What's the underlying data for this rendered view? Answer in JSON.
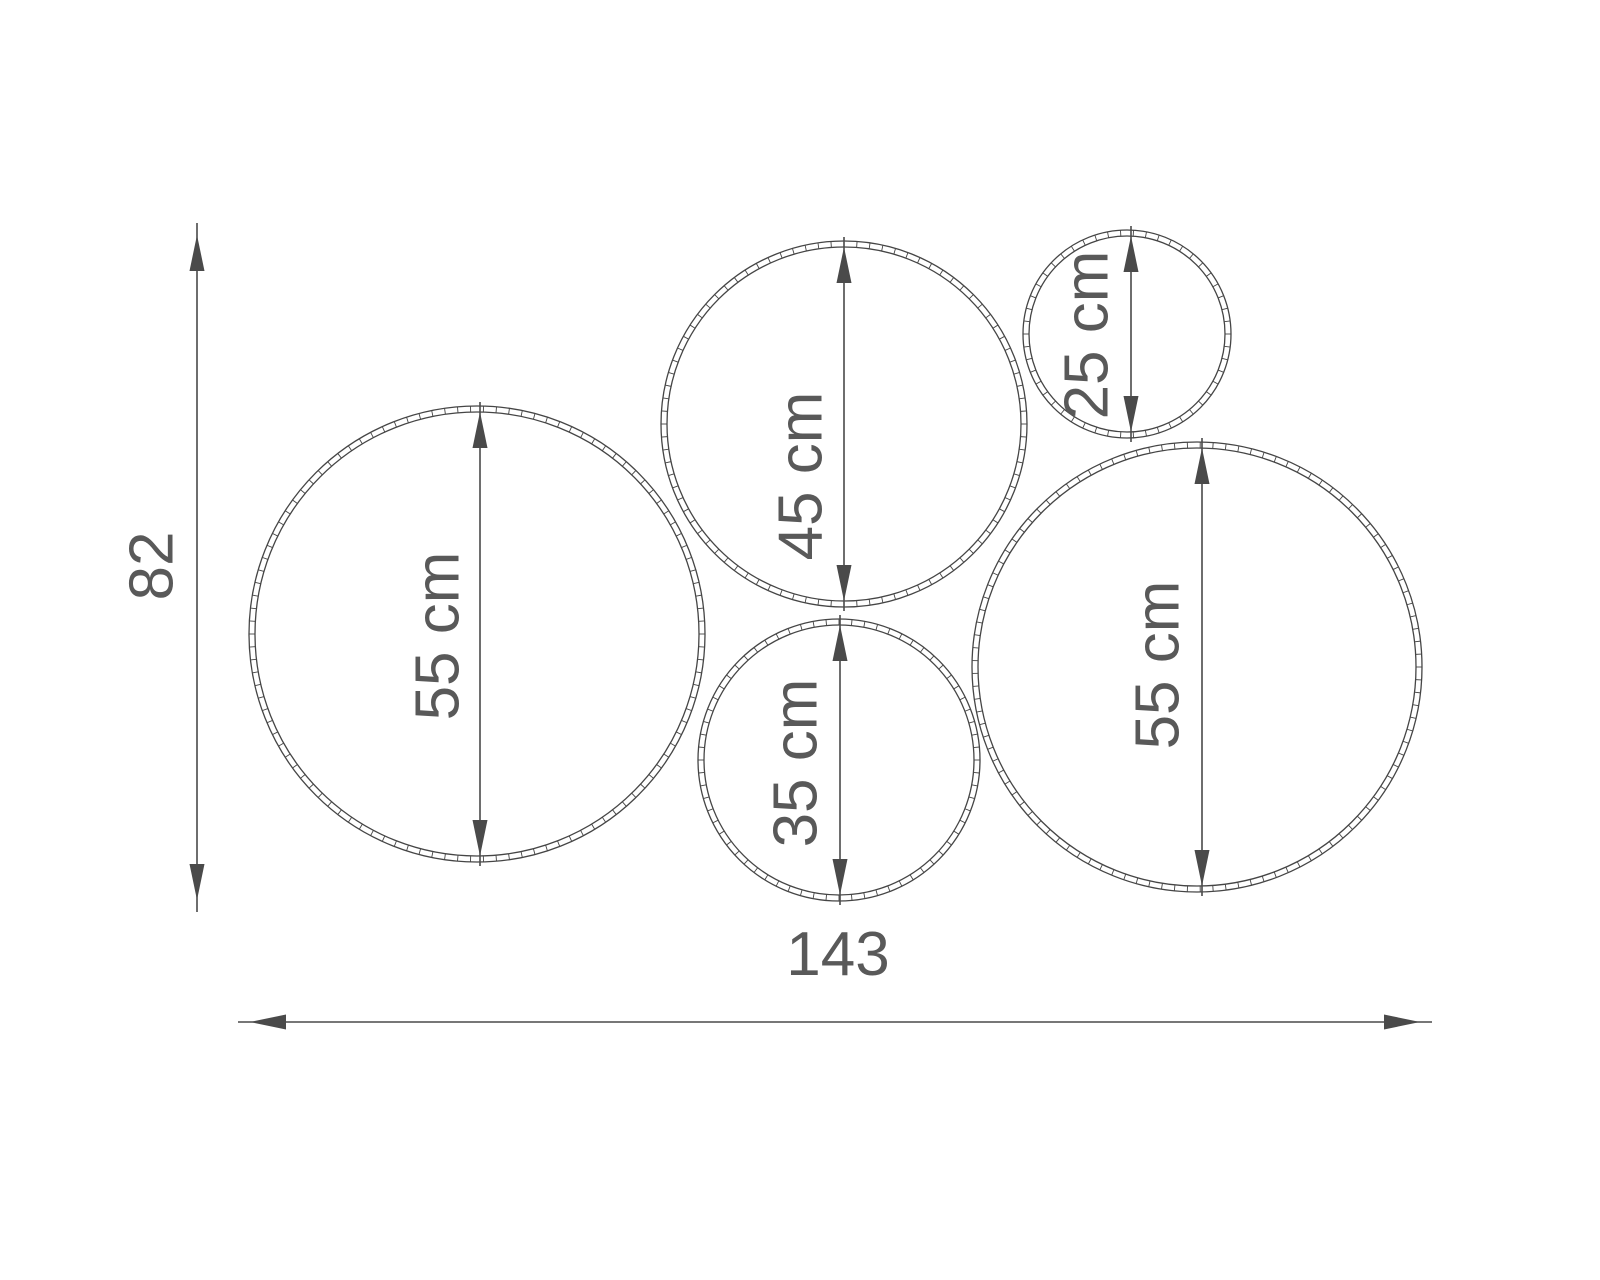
{
  "diagram": {
    "description": "Five-hoop wall arrangement dimension drawing",
    "background": "#ffffff",
    "outline_color": "#454545",
    "dimension_color": "#4a4a4a",
    "text_color": "#595959",
    "unit": "cm",
    "hoops": [
      {
        "name": "hoop-55-left",
        "label": "55 cm",
        "diameter_cm": 55,
        "cx": 477,
        "cy": 634,
        "r": 228,
        "arrow_x": 480,
        "label_x": 437,
        "label_y": 636
      },
      {
        "name": "hoop-45-top",
        "label": "45 cm",
        "diameter_cm": 45,
        "cx": 844,
        "cy": 424,
        "r": 183,
        "arrow_x": 844,
        "label_x": 800,
        "label_y": 476
      },
      {
        "name": "hoop-25-small",
        "label": "25 cm",
        "diameter_cm": 25,
        "cx": 1127,
        "cy": 334,
        "r": 104,
        "arrow_x": 1131,
        "label_x": 1086,
        "label_y": 335
      },
      {
        "name": "hoop-35-bottom",
        "label": "35 cm",
        "diameter_cm": 35,
        "cx": 839,
        "cy": 760,
        "r": 141,
        "arrow_x": 840,
        "label_x": 795,
        "label_y": 763
      },
      {
        "name": "hoop-55-right",
        "label": "55 cm",
        "diameter_cm": 55,
        "cx": 1197,
        "cy": 667,
        "r": 225,
        "arrow_x": 1202,
        "label_x": 1157,
        "label_y": 665
      }
    ],
    "dimensions": [
      {
        "name": "overall-height",
        "label": "82",
        "value_cm": 82,
        "orientation": "vertical",
        "x": 197,
        "from": 235,
        "to": 900,
        "label_x": 151,
        "label_y": 566
      },
      {
        "name": "overall-width",
        "label": "143",
        "value_cm": 143,
        "orientation": "horizontal",
        "y": 1022,
        "from": 250,
        "to": 1420,
        "label_x": 838,
        "label_y": 975
      }
    ],
    "style": {
      "ring_width": 6,
      "tick_spacing": 13,
      "arrow_length": 36,
      "arrow_half_width": 7.5,
      "overshoot": 12
    }
  }
}
